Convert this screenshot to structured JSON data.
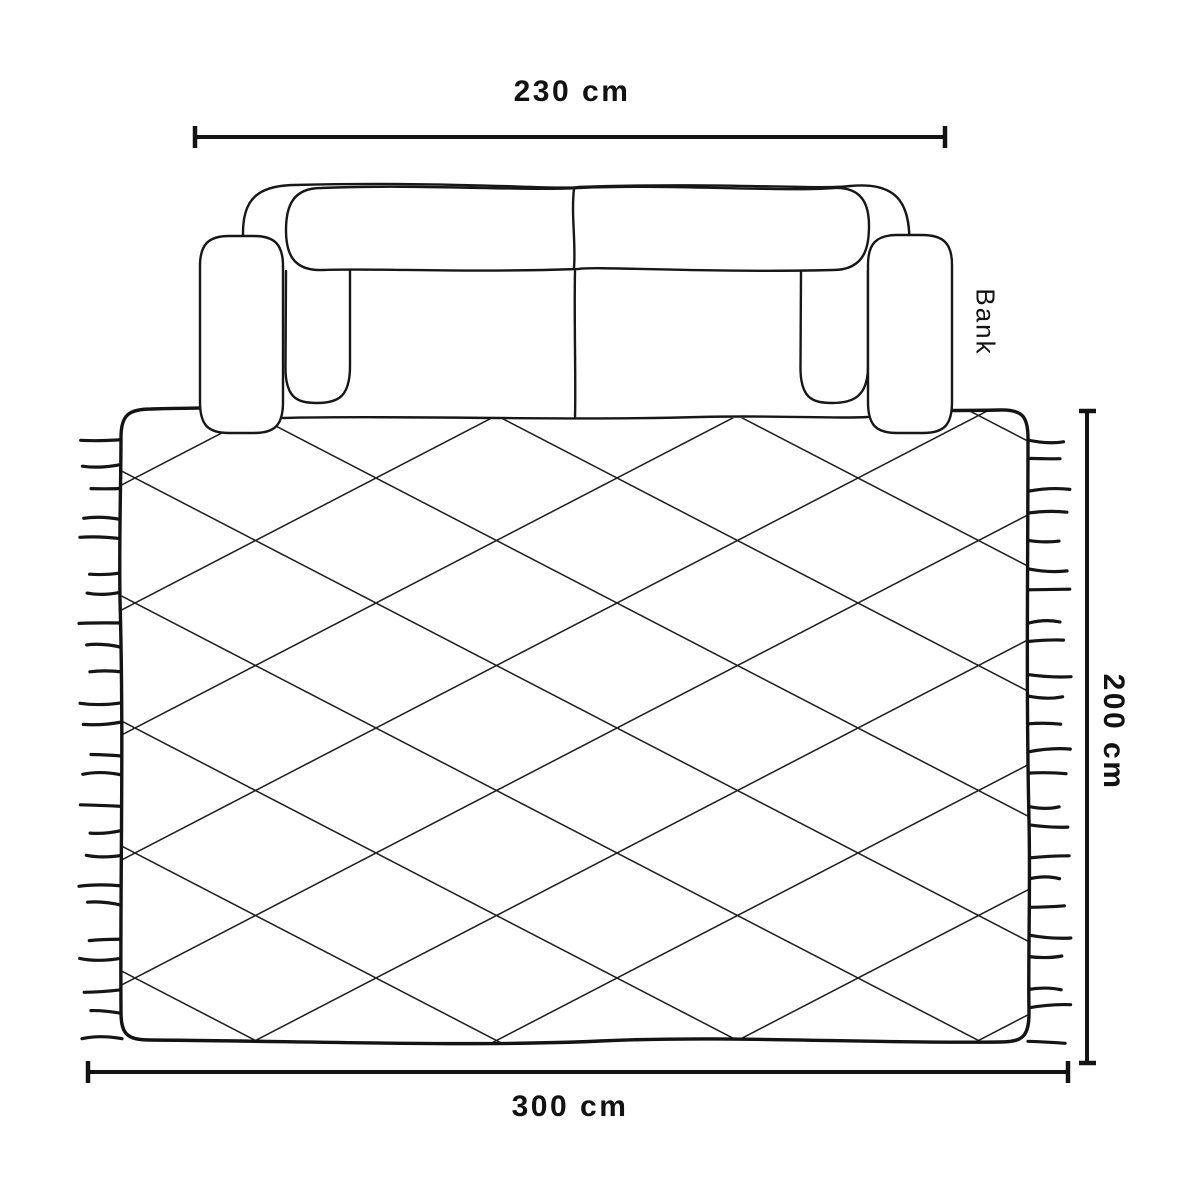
{
  "page": {
    "background_color": "#ffffff",
    "line_color": "#131313"
  },
  "sofa": {
    "label": "Bank",
    "width_label": "230 cm"
  },
  "rug": {
    "width_label": "300 cm",
    "depth_label": "200 cm"
  }
}
